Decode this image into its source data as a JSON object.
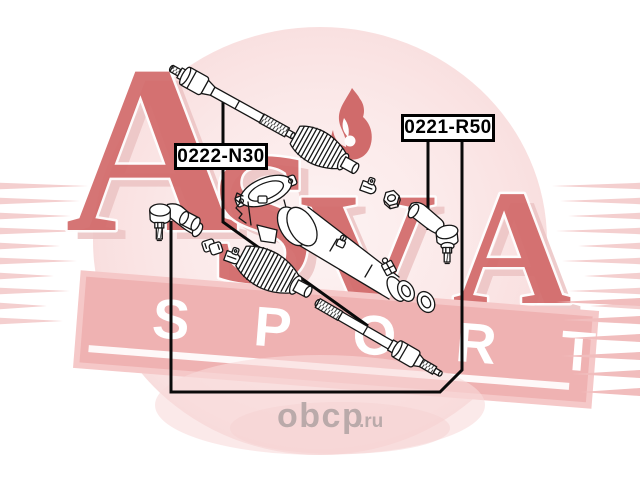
{
  "diagram": {
    "part_labels": [
      {
        "code": "0222-N30"
      },
      {
        "code": "0221-R50"
      }
    ]
  },
  "watermark": {
    "brand": "ASVA",
    "brand_letters": [
      "A",
      "S",
      "V",
      "A"
    ],
    "banner_word": "SPORT",
    "banner_letters": [
      "S",
      "P",
      "O",
      "R",
      "T"
    ],
    "site_text": "obcp",
    "site_suffix": ".ru",
    "colors": {
      "letter_red": "#d26a6a",
      "stripe_pink": "#f4cfcf",
      "banner_pink": "#efb2b2",
      "ellipse_pink": "#fbe9e9",
      "flame_red": "#cb5a5a",
      "site_gray": "#b5a7a7",
      "line_black": "#0a0a0a"
    }
  }
}
